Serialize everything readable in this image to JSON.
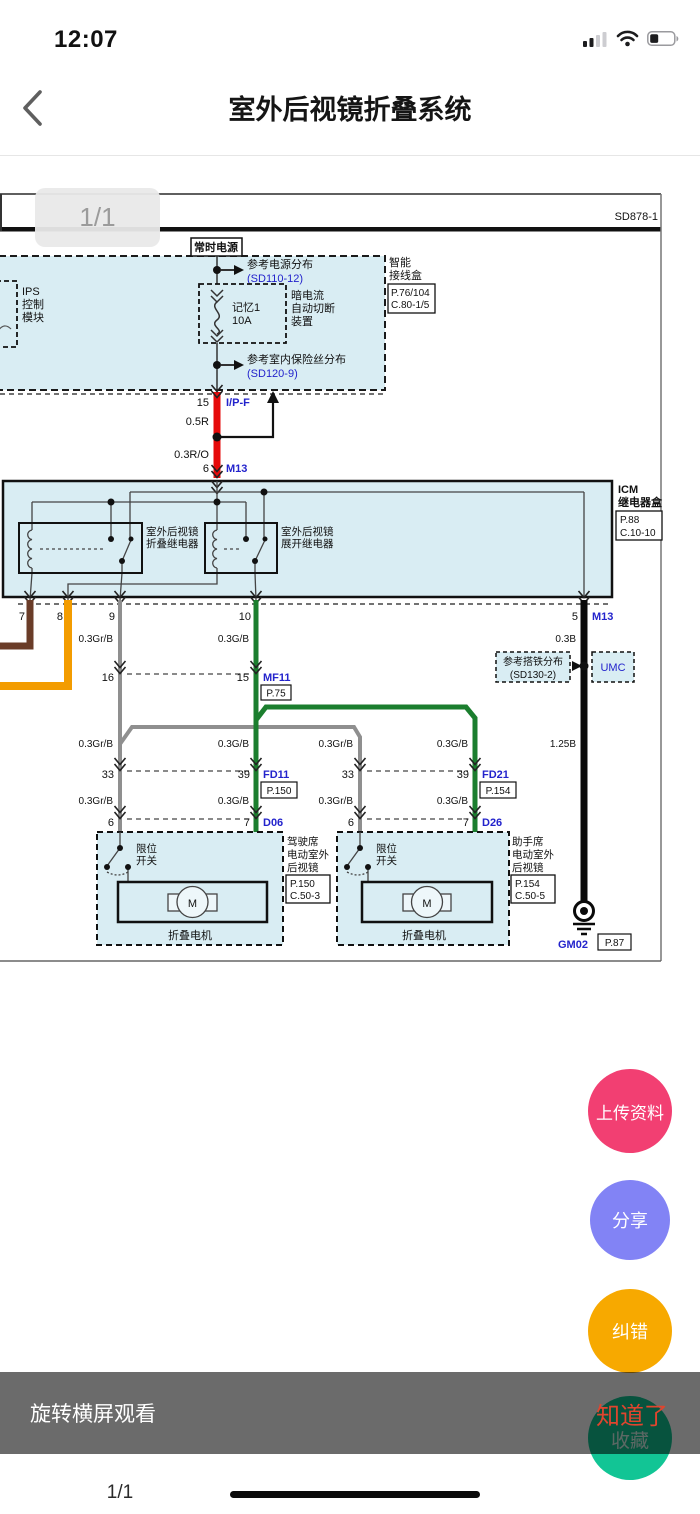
{
  "status_bar": {
    "time": "12:07"
  },
  "header": {
    "title": "室外后视镜折叠系统"
  },
  "viewer": {
    "page_badge": "1/1",
    "sheet_code": "SD878-1"
  },
  "colors": {
    "wire_red": "#e60b0b",
    "wire_brown": "#6a3c28",
    "wire_orange": "#f39c00",
    "wire_gray": "#8f8f8f",
    "wire_green": "#1b7e2e",
    "wire_black": "#0a0a0a",
    "ref_blue": "#2323cc",
    "box_fill": "#d9edf3",
    "fab_upload": "#f23f72",
    "fab_share": "#8283f5",
    "fab_report": "#f7a900",
    "favorite_green": "#12c595",
    "got_it_red": "#e0452e"
  },
  "diagram": {
    "labels": {
      "constant_power": "常时电源",
      "power_dist": "参考电源分布",
      "power_dist_ref": "(SD110-12)",
      "sjb1": "智能",
      "sjb2": "接线盒",
      "sjb_ref1": "P.76/104",
      "sjb_ref2": "C.80-1/5",
      "ips1": "IPS",
      "ips2": "控制",
      "ips3": "模块",
      "dc1": "暗电流",
      "dc2": "自动切断",
      "dc3": "装置",
      "fuse1": "记忆1",
      "fuse2": "10A",
      "fusedist": "参考室内保险丝分布",
      "fusedist_ref": "(SD120-9)",
      "pin15": "15",
      "ipf": "I/P-F",
      "w05r": "0.5R",
      "w03ro": "0.3R/O",
      "pin6": "6",
      "m13": "M13",
      "icm1": "ICM",
      "icm2": "继电器盒",
      "icm_ref1": "P.88",
      "icm_ref2": "C.10-10",
      "relay1a": "室外后视镜",
      "relay1b": "折叠继电器",
      "relay2a": "室外后视镜",
      "relay2b": "展开继电器",
      "pin7": "7",
      "pin8": "8",
      "pin9": "9",
      "pin10": "10",
      "pin5": "5",
      "m13b": "M13",
      "w03grb": "0.3Gr/B",
      "w03gb": "0.3G/B",
      "w03b": "0.3B",
      "w125b": "1.25B",
      "pin16": "16",
      "pin15b": "15",
      "mf11": "MF11",
      "p75": "P.75",
      "gnddist": "参考搭铁分布",
      "gnddist_ref": "(SD130-2)",
      "umc": "UMC",
      "pin33": "33",
      "pin39": "39",
      "fd11": "FD11",
      "p150": "P.150",
      "fd21": "FD21",
      "p154": "P.154",
      "pin6b": "6",
      "pin7b": "7",
      "d06": "D06",
      "d26": "D26",
      "limit1": "限位",
      "limit2": "开关",
      "motor_m": "M",
      "fold_motor": "折叠电机",
      "seat1a": "驾驶席",
      "seat_b": "电动室外",
      "seat_c": "后视镜",
      "seat2a": "助手席",
      "p150b": "P.150",
      "c503": "C.50-3",
      "p154b": "P.154",
      "c505": "C.50-5",
      "gm02": "GM02",
      "p87": "P.87"
    }
  },
  "fabs": {
    "upload": "上传资料",
    "share": "分享",
    "report": "纠错"
  },
  "bottom": {
    "tip": "旋转横屏观看",
    "got_it": "知道了",
    "favorite": "收藏"
  },
  "footer": {
    "page": "1/1"
  }
}
